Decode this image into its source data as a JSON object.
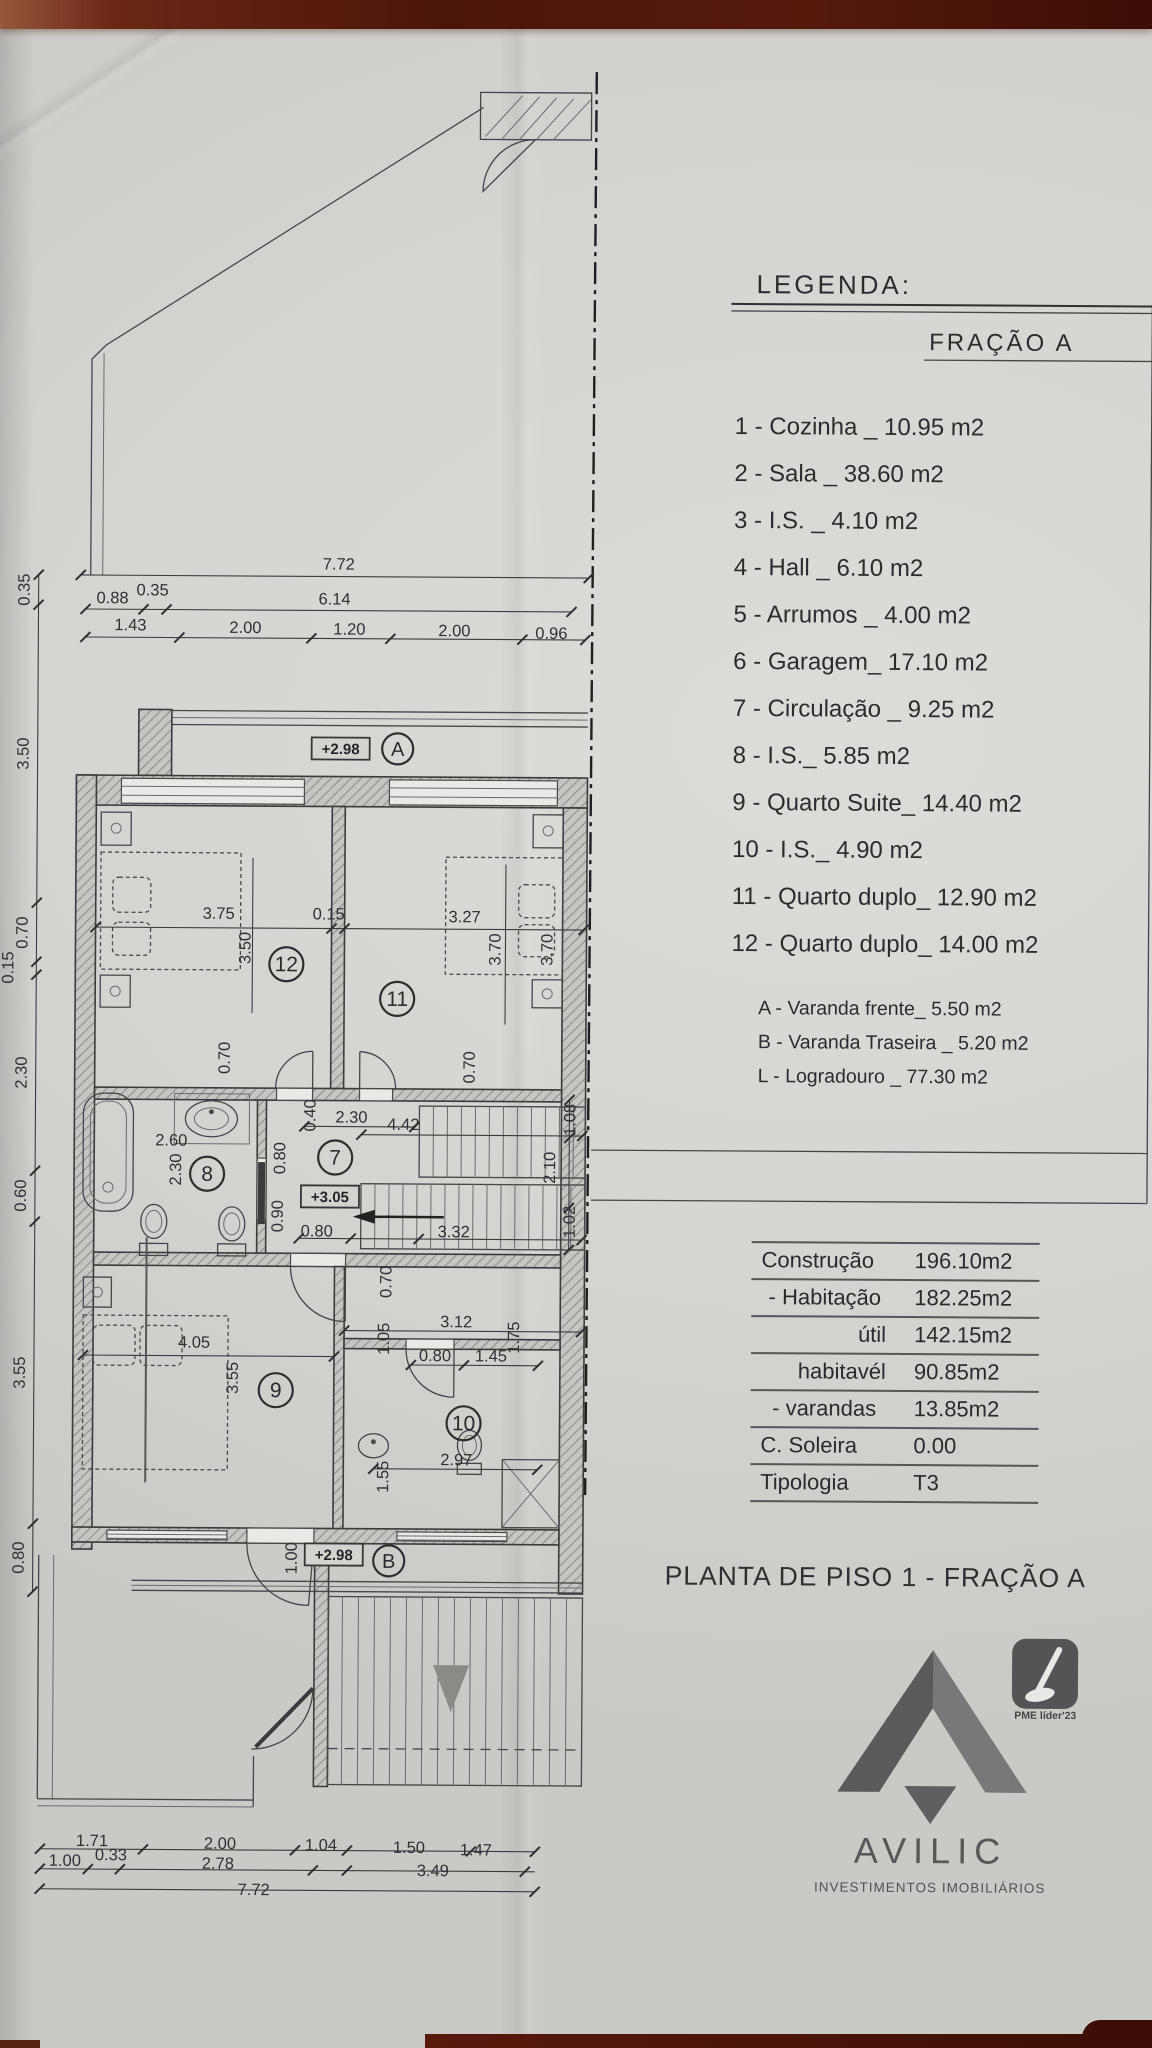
{
  "photo": {
    "paper": "#d5d6d2",
    "desk_top": "#4f150a",
    "desk_accent": "#8a4a35",
    "ink": "#2c2c2e"
  },
  "legend": {
    "title": "LEGENDA:",
    "fraction": "FRAÇÃO A",
    "items": [
      "1 - Cozinha _ 10.95 m2",
      "2 - Sala  _ 38.60 m2",
      "3 - I.S. _ 4.10 m2",
      "4 - Hall _ 6.10 m2",
      "5 - Arrumos _ 4.00 m2",
      "6 - Garagem_ 17.10 m2",
      "7 - Circulação _ 9.25 m2",
      "8 - I.S._ 5.85 m2",
      "9 - Quarto Suite_ 14.40 m2",
      "10 - I.S._ 4.90 m2",
      "11 - Quarto duplo_ 12.90 m2",
      "12 - Quarto duplo_ 14.00 m2"
    ],
    "sub_items": [
      "A - Varanda frente_ 5.50 m2",
      "B - Varanda Traseira _ 5.20 m2",
      "L - Logradouro _ 77.30 m2"
    ]
  },
  "areas_table": {
    "rows": [
      {
        "label": "Construção",
        "value": "196.10m2",
        "align": "left"
      },
      {
        "label": "- Habitação",
        "value": "182.25m2",
        "align": "center"
      },
      {
        "label": "útil",
        "value": "142.15m2",
        "align": "right"
      },
      {
        "label": "habitavél",
        "value": "90.85m2",
        "align": "right"
      },
      {
        "label": "- varandas",
        "value": "13.85m2",
        "align": "center"
      },
      {
        "label": "C. Soleira",
        "value": "0.00",
        "align": "left"
      },
      {
        "label": "Tipologia",
        "value": "T3",
        "align": "left"
      }
    ]
  },
  "title": "PLANTA DE PISO 1 - FRAÇÃO A",
  "logo": {
    "name": "AVILIC",
    "tagline": "INVESTIMENTOS IMOBILIÁRIOS",
    "badge": "PME líder'23"
  },
  "plan": {
    "rooms": [
      {
        "num": "12",
        "x": 286,
        "y": 966
      },
      {
        "num": "11",
        "x": 397,
        "y": 1000
      },
      {
        "num": "8",
        "x": 208,
        "y": 1176
      },
      {
        "num": "7",
        "x": 336,
        "y": 1159
      },
      {
        "num": "9",
        "x": 278,
        "y": 1392
      },
      {
        "num": "10",
        "x": 466,
        "y": 1424
      }
    ],
    "markers": [
      {
        "letter": "A",
        "x": 396,
        "y": 750
      },
      {
        "letter": "B",
        "x": 392,
        "y": 1562
      }
    ],
    "elevations": [
      {
        "text": "+2.98",
        "x": 339,
        "y": 750
      },
      {
        "text": "+3.05",
        "x": 331,
        "y": 1198
      },
      {
        "text": "+2.98",
        "x": 337,
        "y": 1556
      }
    ],
    "dims": [
      {
        "t": "7.72",
        "x": 336,
        "y": 571
      },
      {
        "t": "0.88",
        "x": 110,
        "y": 606
      },
      {
        "t": "0.35",
        "x": 150,
        "y": 598
      },
      {
        "t": "6.14",
        "x": 332,
        "y": 606
      },
      {
        "t": "1.43",
        "x": 128,
        "y": 633
      },
      {
        "t": "2.00",
        "x": 243,
        "y": 635
      },
      {
        "t": "1.20",
        "x": 347,
        "y": 636
      },
      {
        "t": "2.00",
        "x": 452,
        "y": 637
      },
      {
        "t": "0.96",
        "x": 549,
        "y": 639
      },
      {
        "t": "0.35",
        "x": 27,
        "y": 593,
        "r": 1
      },
      {
        "t": "3.50",
        "x": 27,
        "y": 757,
        "r": 1
      },
      {
        "t": "0.70",
        "x": 27,
        "y": 936,
        "r": 1
      },
      {
        "t": "0.15",
        "x": 13,
        "y": 971,
        "r": 1
      },
      {
        "t": "2.30",
        "x": 27,
        "y": 1076,
        "r": 1
      },
      {
        "t": "0.60",
        "x": 27,
        "y": 1199,
        "r": 1
      },
      {
        "t": "3.55",
        "x": 27,
        "y": 1376,
        "r": 1
      },
      {
        "t": "0.80",
        "x": 27,
        "y": 1561,
        "r": 1
      },
      {
        "t": "3.75",
        "x": 218,
        "y": 921
      },
      {
        "t": "0.15",
        "x": 328,
        "y": 921
      },
      {
        "t": "3.27",
        "x": 464,
        "y": 923
      },
      {
        "t": "3.50",
        "x": 250,
        "y": 950,
        "r": 1
      },
      {
        "t": "3.70",
        "x": 500,
        "y": 950,
        "r": 1
      },
      {
        "t": "3.70",
        "x": 552,
        "y": 950,
        "r": 1
      },
      {
        "t": "0.70",
        "x": 230,
        "y": 1060,
        "r": 1
      },
      {
        "t": "0.70",
        "x": 475,
        "y": 1068,
        "r": 1
      },
      {
        "t": "2.60",
        "x": 172,
        "y": 1148
      },
      {
        "t": "2.30",
        "x": 182,
        "y": 1172,
        "r": 1
      },
      {
        "t": "0.40",
        "x": 316,
        "y": 1117,
        "r": 1
      },
      {
        "t": "2.30",
        "x": 352,
        "y": 1124
      },
      {
        "t": "4.42",
        "x": 404,
        "y": 1131
      },
      {
        "t": "0.80",
        "x": 286,
        "y": 1160,
        "r": 1
      },
      {
        "t": "0.90",
        "x": 284,
        "y": 1218,
        "r": 1
      },
      {
        "t": "0.80",
        "x": 318,
        "y": 1238
      },
      {
        "t": "3.32",
        "x": 455,
        "y": 1238
      },
      {
        "t": "2.10",
        "x": 556,
        "y": 1168,
        "r": 1
      },
      {
        "t": "1.08",
        "x": 576,
        "y": 1120,
        "r": 1
      },
      {
        "t": "1.02",
        "x": 576,
        "y": 1222,
        "r": 1
      },
      {
        "t": "0.70",
        "x": 393,
        "y": 1283,
        "r": 1
      },
      {
        "t": "3.12",
        "x": 458,
        "y": 1328
      },
      {
        "t": "1.05",
        "x": 391,
        "y": 1340,
        "r": 1
      },
      {
        "t": "1.75",
        "x": 521,
        "y": 1338,
        "r": 1
      },
      {
        "t": "0.80",
        "x": 437,
        "y": 1362
      },
      {
        "t": "1.45",
        "x": 493,
        "y": 1362
      },
      {
        "t": "4.05",
        "x": 196,
        "y": 1350
      },
      {
        "t": "3.55",
        "x": 240,
        "y": 1380,
        "r": 1
      },
      {
        "t": "2.97",
        "x": 459,
        "y": 1466
      },
      {
        "t": "1.55",
        "x": 391,
        "y": 1478,
        "r": 1
      },
      {
        "t": "1.00",
        "x": 300,
        "y": 1560,
        "r": 1
      },
      {
        "t": "1.71",
        "x": 97,
        "y": 1849
      },
      {
        "t": "2.00",
        "x": 225,
        "y": 1851
      },
      {
        "t": "1.04",
        "x": 326,
        "y": 1852
      },
      {
        "t": "1.50",
        "x": 414,
        "y": 1854
      },
      {
        "t": "1.47",
        "x": 481,
        "y": 1856
      },
      {
        "t": "1.00",
        "x": 70,
        "y": 1869
      },
      {
        "t": "0.33",
        "x": 116,
        "y": 1863
      },
      {
        "t": "2.78",
        "x": 223,
        "y": 1871
      },
      {
        "t": "3.49",
        "x": 438,
        "y": 1877
      },
      {
        "t": "7.72",
        "x": 259,
        "y": 1897
      }
    ]
  }
}
